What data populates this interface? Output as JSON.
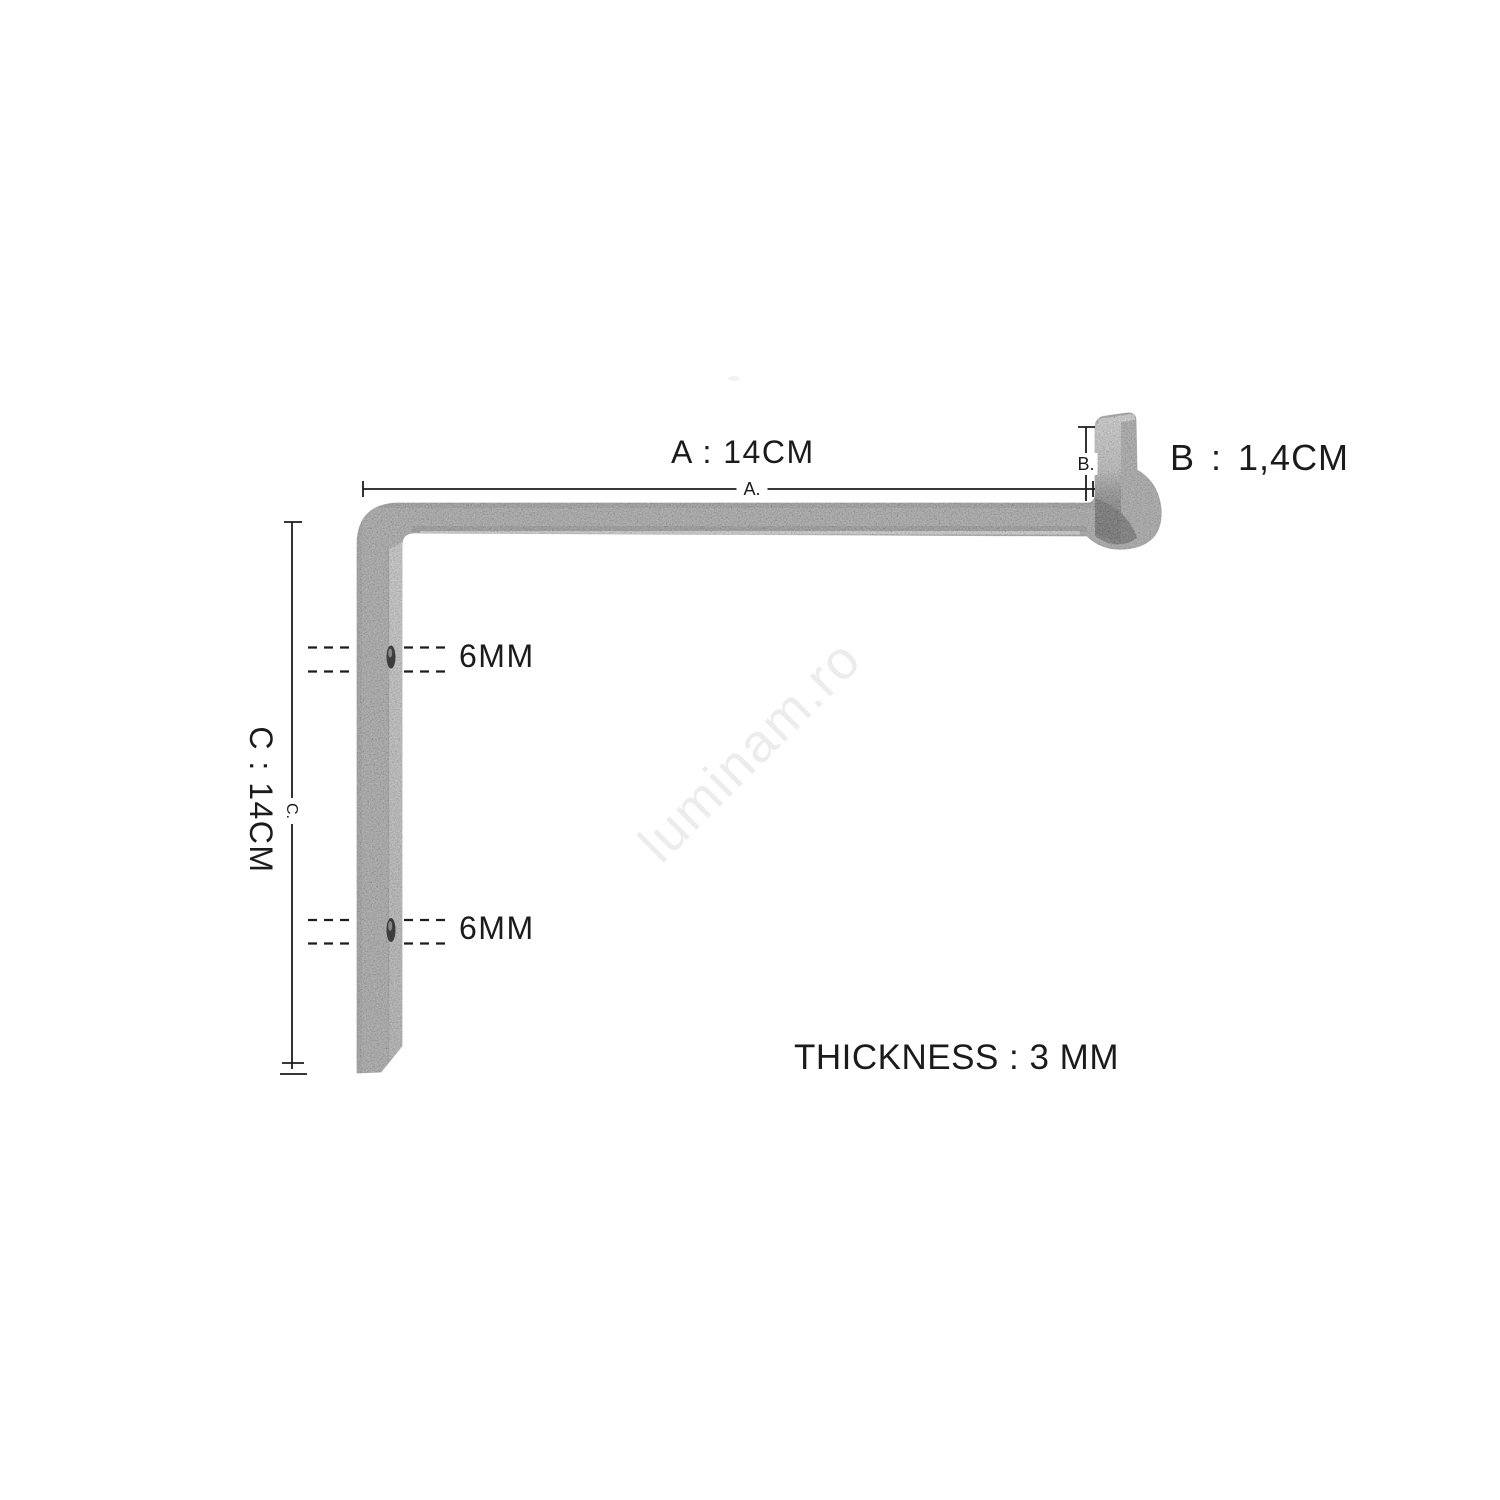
{
  "diagram": {
    "background_color": "#ffffff",
    "annotation_color": "#1b1b1b",
    "metal_color": "#8f8f8f",
    "dim_a": {
      "label": "A : 14CM",
      "line_label": "A."
    },
    "dim_b": {
      "label": "B : 1,4CM",
      "line_label": "B."
    },
    "dim_c": {
      "label": "C : 14CM",
      "line_label": "C."
    },
    "holes": [
      {
        "label": "6MM"
      },
      {
        "label": "6MM"
      }
    ],
    "thickness_label": "THICKNESS : 3 MM",
    "watermark": {
      "text": "luminam.ro",
      "color": "#ececec"
    }
  }
}
